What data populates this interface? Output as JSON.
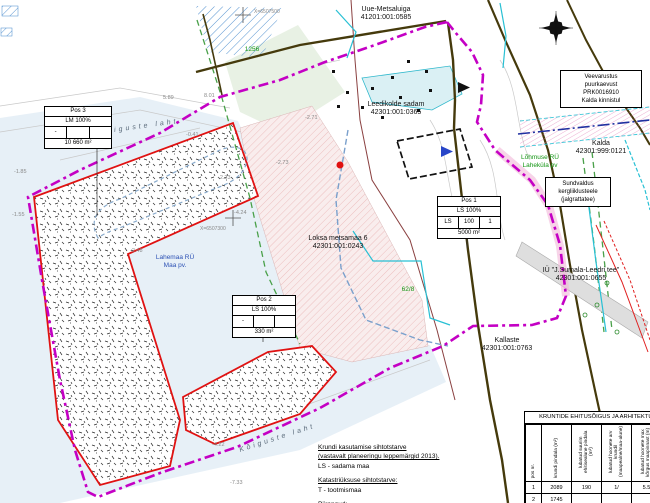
{
  "parcels": [
    {
      "name": "Uue-Metsaluiga",
      "code": "41201:001:0585"
    },
    {
      "name": "Leedikolde sadam",
      "code": "42301:001:0365"
    },
    {
      "name": "Loksa metsamaa 6",
      "code": "42301:001:0243"
    },
    {
      "name": "Kallaste",
      "code": "42301:001:0763"
    },
    {
      "name": "IÜ \"J.Sumala-Leedri tee\"",
      "code": "42301:001:0655"
    },
    {
      "name": "Kalda",
      "code": "42301:999:0121"
    }
  ],
  "water_labels": [
    "Kõiguste laht",
    "Kõiguste laht"
  ],
  "zone_labels": {
    "blue1": "Lahemaa RÜ",
    "blue2": "Maa pv.",
    "green1": "Lõhmuse RÜ",
    "green2": "Laheküla pv"
  },
  "green_numbers": [
    "1256",
    "62/8",
    "0,76"
  ],
  "note_boxes": {
    "well": [
      "Veevarustus",
      "puurkaevust",
      "PRK0016910",
      "Kalda kinnistul"
    ],
    "servitude": [
      "Sundvaldus",
      "kergliiklusteele",
      "(jalgrattatee)"
    ]
  },
  "stamps": [
    {
      "pos": "Pos 1",
      "use": "LS 100%",
      "c1": "LS",
      "c2": "100",
      "c3": "1",
      "area": "5000 m²"
    },
    {
      "pos": "Pos 2",
      "use": "LS 100%",
      "c1": "-",
      "c2": "",
      "c3": "",
      "area": "330 m²"
    },
    {
      "pos": "Pos 3",
      "use": "LM 100%",
      "c1": "-",
      "c2": "",
      "c3": "",
      "area": "10 660 m²"
    }
  ],
  "elevations": [
    "5.89",
    "8.01",
    "-2.71",
    "-0.41",
    "-2.48",
    "-2.23",
    "-4.24",
    "-1.85",
    "-1.55",
    "-4.22",
    "-7.33",
    "-2.73"
  ],
  "survey_marks": [
    "X=6507500",
    "X=6507300"
  ],
  "legend": {
    "title1": "Krundi kasutamise sihtotstarve",
    "sub1": "(vastavalt planeeringu leppemärgid 2013).",
    "item1": "LS - sadama maa",
    "title2": "Katastriüksuse sihtotstarve:",
    "item2": "T - tootmismaa",
    "title3": "Piirangud:"
  },
  "table": {
    "title": "KRUNTIDE EHITUSÕIGUS JA ARHITEKTUUR",
    "columns": [
      "pos nr.",
      "krundi pindala (m²)",
      "lubatud suurim ehitisealune pindala (m²)",
      "lubatud hoonete arv krundil (maapealne/maa-alune)",
      "lubatud hoonete max kõrgus maapinnast (m)"
    ],
    "rows": [
      [
        "1",
        "2089",
        "190",
        "1/",
        "5.5"
      ],
      [
        "2",
        "1745",
        "",
        "",
        ""
      ]
    ]
  }
}
